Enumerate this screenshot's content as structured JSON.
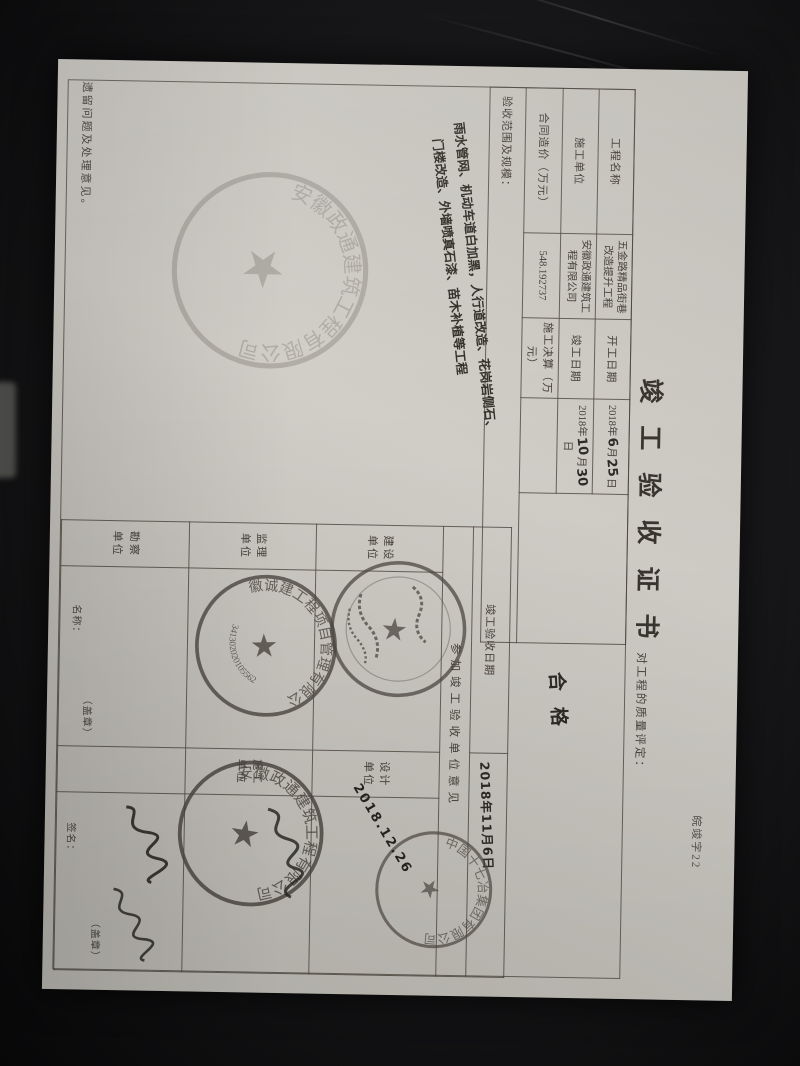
{
  "form_code": "皖竣字22",
  "title": "竣工验收证书",
  "upper_table": {
    "project_name_label": "工程名称",
    "project_name": "五金路精品街巷改造提升工程",
    "start_date_label": "开工日期",
    "start_date": {
      "year": "2018年",
      "month": "6",
      "month_unit": "月",
      "day": "25",
      "day_unit": "日"
    },
    "contractor_label": "施工单位",
    "contractor": "安徽政通建筑工程有限公司",
    "finish_date_label": "竣工日期",
    "finish_date": {
      "year": "2018年",
      "month": "10",
      "month_unit": "月",
      "day": "30",
      "day_unit": "日"
    },
    "contract_price_label": "合同造价（万元）",
    "contract_price": "548.192737",
    "settlement_label": "施工决算（万元）",
    "settlement": "",
    "scope_label": "验收范围及规模：",
    "scope_line1": "雨水管网、机动车道白加黑，人行道改造、花岗岩侧石、",
    "scope_line2": "门楼改造、外墙喷真石漆、苗木补植等工程"
  },
  "quality": {
    "label": "对工程的质量评定：",
    "value": "合格"
  },
  "lower_table": {
    "acceptance_date_label": "竣工验收日期",
    "acceptance_date": "2018年11月6日",
    "participants_label": "参加竣工验收单位意见",
    "unit_labels": {
      "construction": "建设单位",
      "design": "设计单位",
      "supervision": "监理单位",
      "contractor": "施工单位",
      "survey": "勘察单位"
    },
    "cell_small_labels": {
      "name": "名称：",
      "seal": "（盖章）",
      "sign": "签名：",
      "seal2": "（盖章）"
    },
    "handwritten_date": "2018.12.26"
  },
  "remark_label": "遗留问题及处理意见。",
  "stamps": {
    "star": "★",
    "faint": {
      "arc_text": "安徽政通建筑工程有限公司"
    },
    "construction": {
      "arc_text": ""
    },
    "supervision": {
      "arc_text": "安徽诚建工程项目管理有限公司",
      "serial": "341302020105562"
    },
    "design": {
      "arc_text": "中国十七冶集团有限公司"
    },
    "contractor": {
      "arc_text": "安徽政通建筑工程有限公司"
    }
  },
  "colors": {
    "paper": "#cfccc5",
    "ink": "#46413a",
    "stamp": "#4a453e",
    "background": "#161618"
  }
}
